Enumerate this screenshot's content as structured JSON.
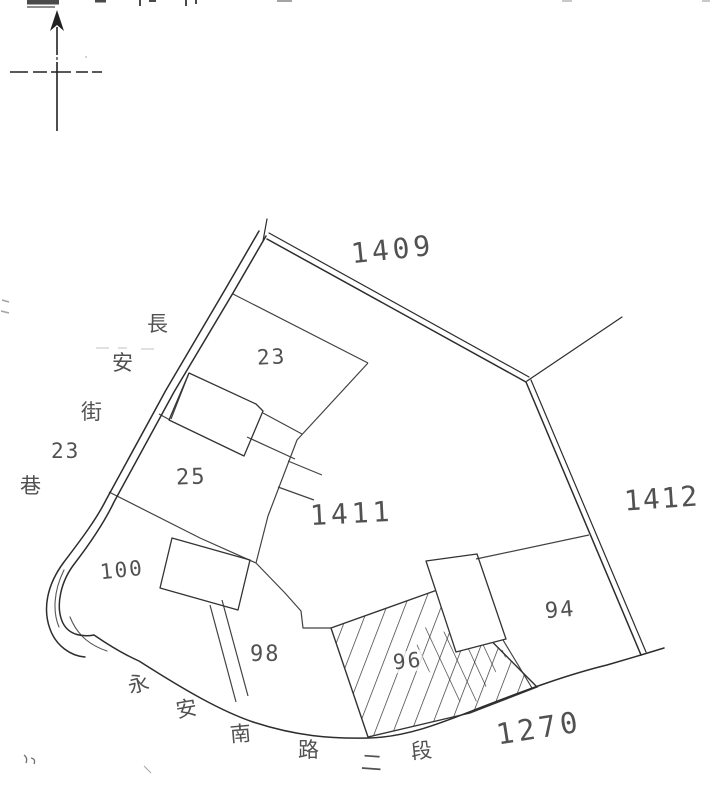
{
  "document": {
    "type": "scanned cadastral parcel sketch map",
    "orientation": "north arrow at top-left"
  },
  "colors": {
    "ink": "#333333",
    "paper": "#ffffff"
  },
  "icons": {
    "north_arrow": "compass-north-arrow"
  },
  "labels": {
    "l1409": "1409",
    "l1411": "1411",
    "l1412": "1412",
    "l1270": "1270",
    "p23": "23",
    "p25": "25",
    "p100": "100",
    "p98": "98",
    "p96": "96",
    "p94": "94"
  },
  "street_left": {
    "name": "長安街23巷",
    "chars": [
      "長",
      "安",
      "街",
      "23",
      "巷"
    ]
  },
  "street_bottom": {
    "name": "永安南路二段",
    "chars": [
      "永",
      "安",
      "南",
      "路",
      "二",
      "段"
    ]
  },
  "features": {
    "hatched_parcel": "96",
    "parcel_numbers": [
      "23",
      "25",
      "100",
      "98",
      "96",
      "94"
    ],
    "block_numbers": [
      "1409",
      "1411",
      "1412",
      "1270"
    ]
  }
}
